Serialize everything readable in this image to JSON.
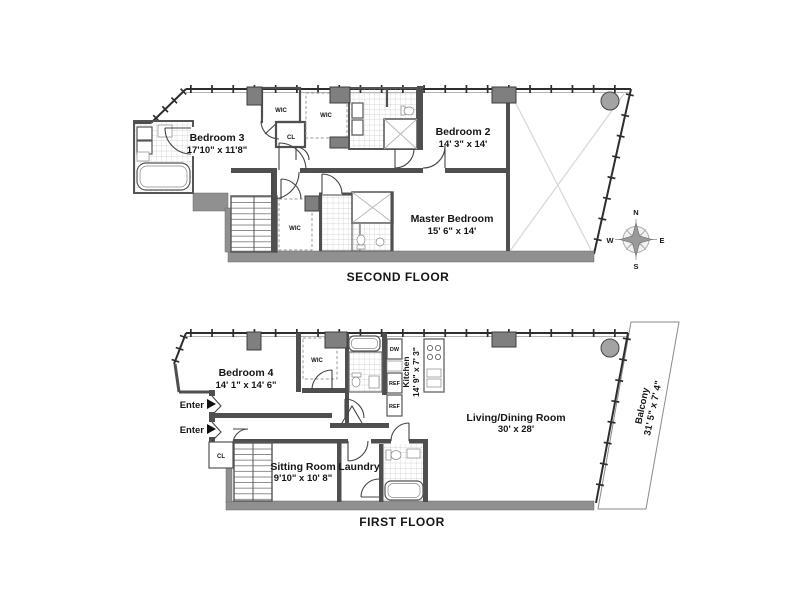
{
  "page": {
    "background": "#ffffff"
  },
  "colors": {
    "wall": "#4f4f4f",
    "structure_band": "#909090",
    "column": "#7f7f7f",
    "round_column": "#a3a3a3",
    "tile_line": "#c6c6c6",
    "diagonal": "#d9d9d9",
    "text": "#161616"
  },
  "floors": {
    "second": {
      "title": "SECOND FLOOR",
      "bedroom3": {
        "name": "Bedroom 3",
        "dims": "17'10\" x 11'8\""
      },
      "bedroom2": {
        "name": "Bedroom 2",
        "dims": "14' 3\" x 14'"
      },
      "master": {
        "name": "Master Bedroom",
        "dims": "15' 6\" x 14'"
      },
      "wic_top_left": "WIC",
      "wic_top_right": "WIC",
      "closet": "CL",
      "master_wic": "WIC"
    },
    "first": {
      "title": "FIRST FLOOR",
      "bedroom4": {
        "name": "Bedroom 4",
        "dims": "14' 1\" x 14' 6\""
      },
      "sitting": {
        "name": "Sitting Room",
        "dims": "9'10\" x 10' 8\""
      },
      "laundry": {
        "name": "Laundry"
      },
      "living": {
        "name": "Living/Dining Room",
        "dims": "30' x 28'"
      },
      "kitchen": {
        "name": "Kitchen",
        "dims": "14' 9\" x 7' 3\""
      },
      "balcony": {
        "name": "Balcony",
        "dims": "31' 5\" x 7' 4\""
      },
      "wic": "WIC",
      "closet": "CL",
      "dishwasher": "DW",
      "fridge_top": "REF",
      "fridge_bottom": "REF",
      "entry1": "Enter",
      "entry2": "Enter"
    }
  },
  "compass": {
    "north": "N",
    "east": "E",
    "south": "S",
    "west": "W"
  }
}
